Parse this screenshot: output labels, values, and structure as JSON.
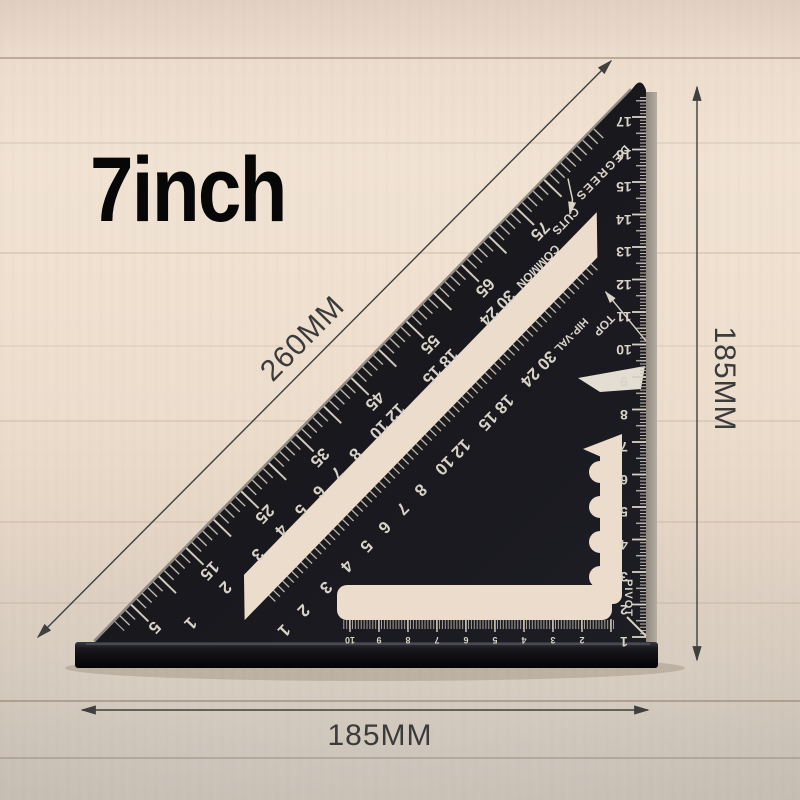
{
  "title": "7inch",
  "dimensions": {
    "hypotenuse": "260MM",
    "right": "185MM",
    "bottom": "185MM"
  },
  "square": {
    "words": {
      "degrees": "DEGREES",
      "common": "COMMON",
      "cuts": "CUTS",
      "hip_val": "HIP-VAL",
      "top": "TOP",
      "pivot": "PIVOT"
    },
    "degree_scale": [
      "5",
      "15",
      "25",
      "35",
      "45",
      "55",
      "65",
      "75"
    ],
    "common_scale": [
      "1",
      "2",
      "3",
      "4",
      "5",
      "6",
      "7",
      "8",
      "12 10",
      "18 15",
      "30 24"
    ],
    "hip_val_scale": [
      "1",
      "2",
      "3",
      "4",
      "5",
      "6",
      "7",
      "8",
      "12 10",
      "18 15",
      "30 24"
    ],
    "right_scale": [
      "17",
      "16",
      "15",
      "14",
      "13",
      "12",
      "11",
      "10",
      "9",
      "8",
      "7",
      "6",
      "5",
      "4",
      "3",
      "2",
      "1"
    ],
    "bottom_scale": [
      "10",
      "9",
      "8",
      "7",
      "6",
      "5",
      "4",
      "3",
      "2"
    ]
  },
  "colors": {
    "square_body": "#1a1a20",
    "markings": "#d8d3c7",
    "wood": "#eee0d0",
    "dimension_lines": "#3f3f3f",
    "title_text": "#070707"
  }
}
